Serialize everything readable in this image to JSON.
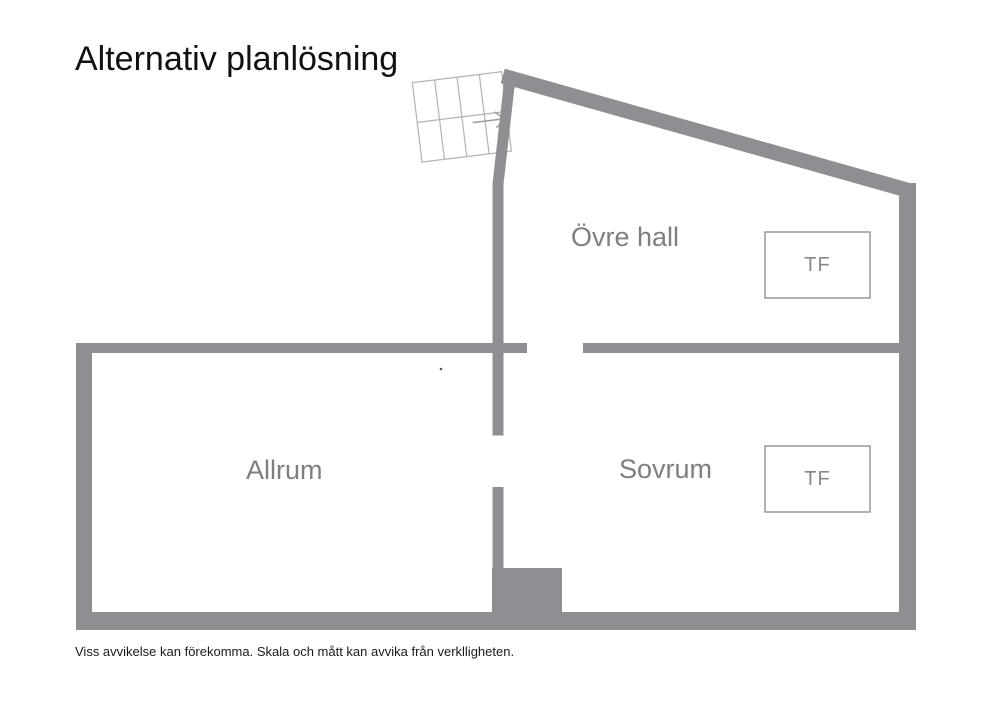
{
  "title": "Alternativ planlösning",
  "rooms": {
    "upper_hall": {
      "label": "Övre hall"
    },
    "living_room": {
      "label": "Allrum"
    },
    "bedroom": {
      "label": "Sovrum"
    }
  },
  "fixtures": {
    "tf_label": "TF"
  },
  "disclaimer": "Viss avvikelse kan förekomma. Skala och mått kan avvika från verklligheten.",
  "colors": {
    "wall": "#8f8f93",
    "stairs_line": "#b3b3b6",
    "arrow": "#9b9b9f",
    "tf_border": "#98989c",
    "room_label": "#7f7f83",
    "text": "#1a1a1a"
  }
}
